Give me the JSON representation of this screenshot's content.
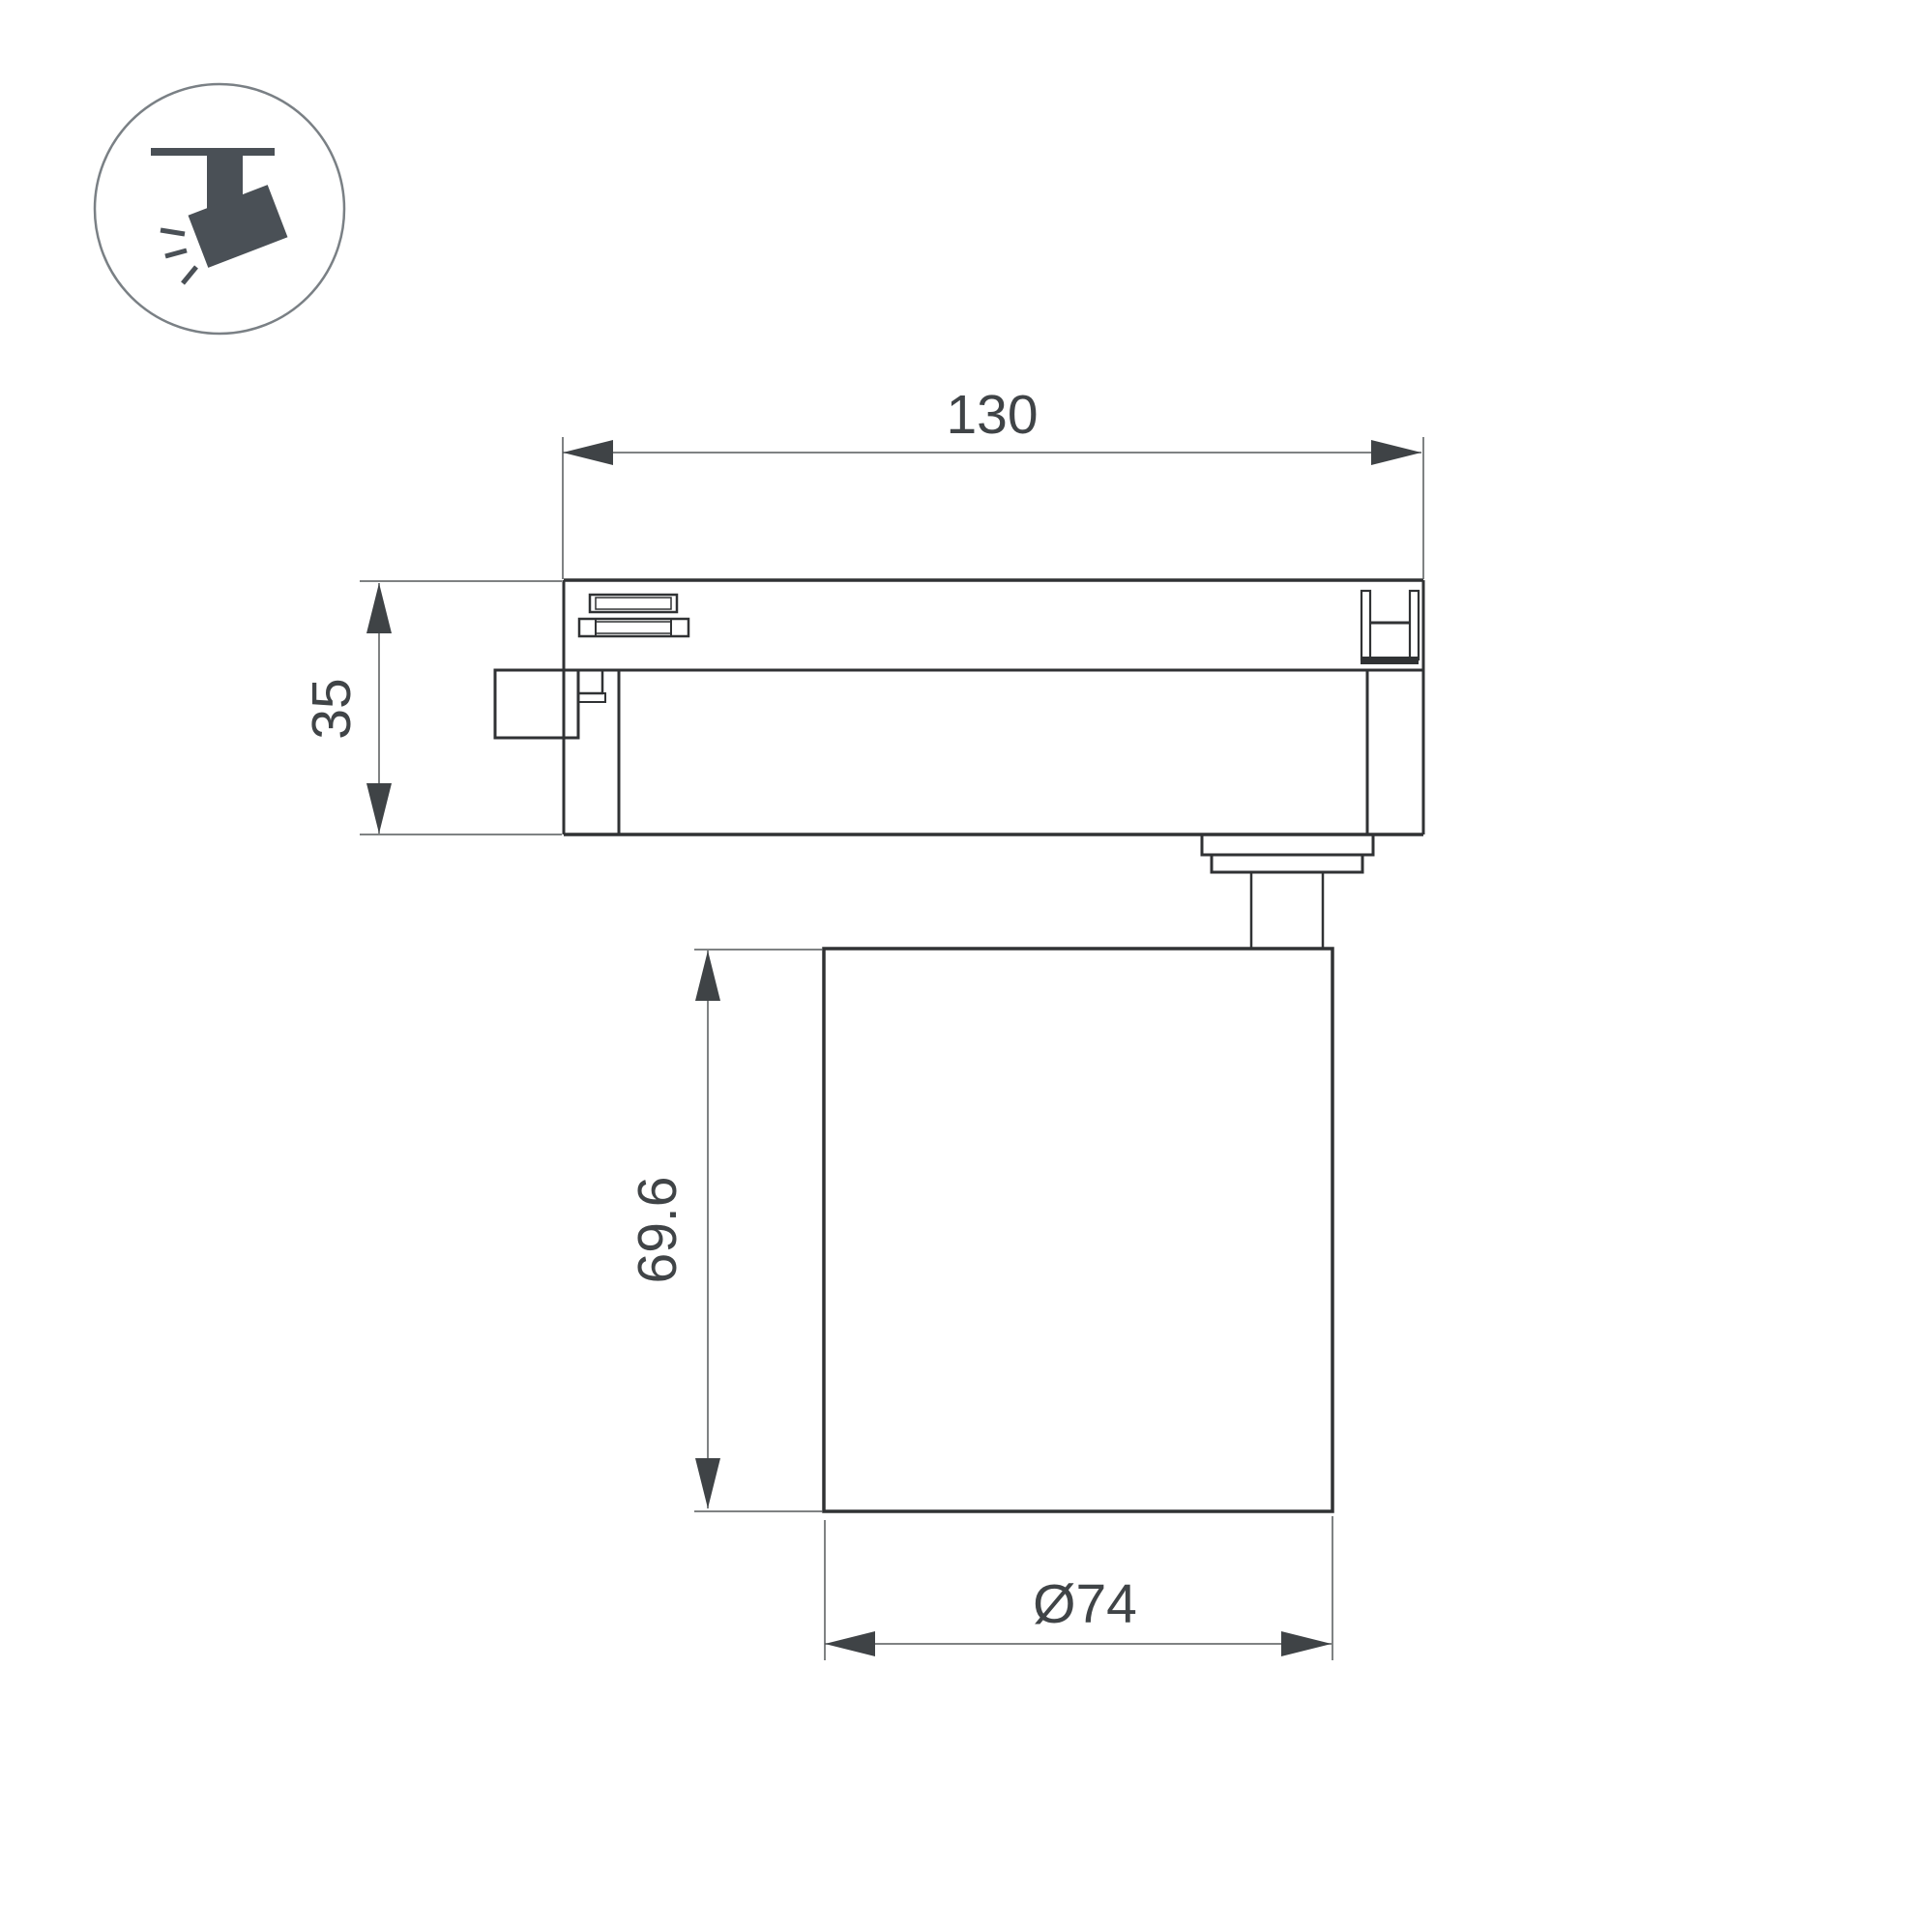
{
  "icon": {
    "name": "track-spotlight-icon"
  },
  "drawing": {
    "dimensions": {
      "overall_width": {
        "label": "130"
      },
      "adapter_height": {
        "label": "35"
      },
      "head_height": {
        "label": "69.6"
      },
      "head_diameter": {
        "label": "Ø74"
      }
    },
    "colors": {
      "background": "#ffffff",
      "outline": "#303234",
      "dimension_line": "#55585a",
      "arrow_fill": "#3f4346",
      "text": "#404447",
      "icon_fill": "#4a5056",
      "icon_circle_stroke": "#7a8085"
    }
  }
}
